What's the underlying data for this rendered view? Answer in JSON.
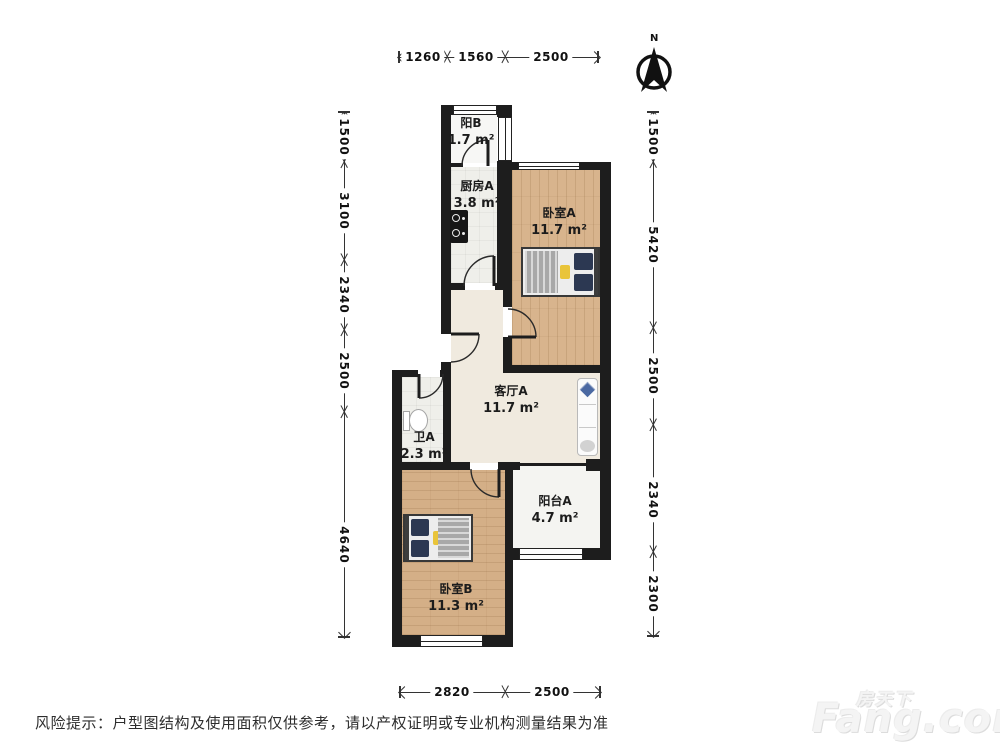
{
  "floorplan": {
    "compass": {
      "label": "N"
    },
    "rooms": [
      {
        "name": "阳B",
        "area": "1.7 m²"
      },
      {
        "name": "厨房A",
        "area": "3.8 m²"
      },
      {
        "name": "卧室A",
        "area": "11.7 m²"
      },
      {
        "name": "客厅A",
        "area": "11.7 m²"
      },
      {
        "name": "卫A",
        "area": "2.3 m²"
      },
      {
        "name": "阳台A",
        "area": "4.7 m²"
      },
      {
        "name": "卧室B",
        "area": "11.3 m²"
      }
    ],
    "dimensions_mm": {
      "top": [
        "1260",
        "1560",
        "2500"
      ],
      "left": [
        "1500",
        "3100",
        "2340",
        "2500",
        "4640"
      ],
      "right": [
        "1500",
        "5420",
        "2500",
        "2340",
        "2300"
      ],
      "bottom": [
        "2820",
        "2500"
      ]
    },
    "colors": {
      "wall": "#1d1d1d",
      "wood_floor": "#d8b48d",
      "living_floor": "#f0eadf",
      "bed_pillow": "#2c3852",
      "accent_pillow": "#e9c43a",
      "sofa_pillow": "#4b69a2"
    }
  },
  "footer": {
    "disclaimer": "风险提示：户型图结构及使用面积仅供参考，请以产权证明或专业机构测量结果为准"
  },
  "watermark": {
    "brand_cn": "房天下",
    "brand_en": "Fang.com"
  }
}
